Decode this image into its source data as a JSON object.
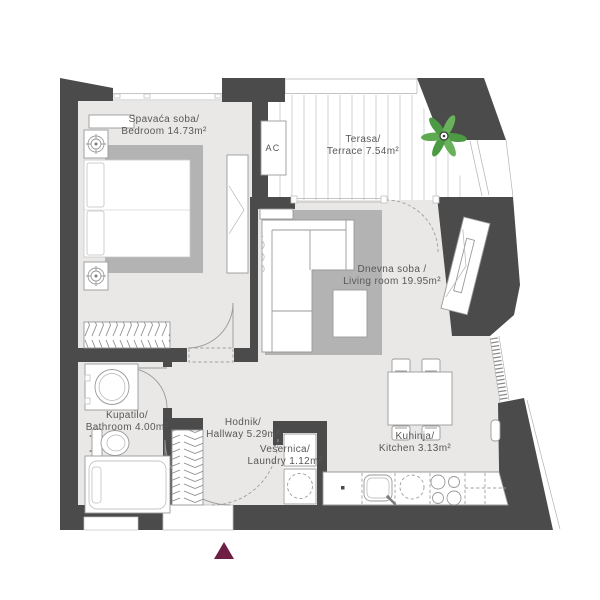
{
  "rooms": [
    {
      "id": "bedroom",
      "line1": "Spavaća soba/",
      "line2": "Bedroom 14.73m²",
      "area": "14.73m²"
    },
    {
      "id": "terrace",
      "line1": "Terasa/",
      "line2": "Terrace 7.54m²",
      "area": "7.54m²"
    },
    {
      "id": "living-room",
      "line1": "Dnevna soba /",
      "line2": "Living room 19.95m²",
      "area": "19.95m²"
    },
    {
      "id": "bathroom",
      "line1": "Kupatilo/",
      "line2": "Bathroom 4.00m²",
      "area": "4.00m²"
    },
    {
      "id": "hallway",
      "line1": "Hodnik/",
      "line2": "Hallway 5.29m²",
      "area": "5.29m²"
    },
    {
      "id": "laundry",
      "line1": "Vešernica/",
      "line2": "Laundry 1.12m²",
      "area": "1.12m²"
    },
    {
      "id": "kitchen",
      "line1": "Kuhinja/",
      "line2": "Kitchen 3.13m²",
      "area": "3.13m²"
    }
  ],
  "labels": {
    "ac_unit": "AC"
  },
  "colors": {
    "wall": "#4b4b4b",
    "floor": "#e9e8e6",
    "rug": "#b3b3b3",
    "furniture_outline": "#9a9a9a",
    "text": "#585858",
    "plant_green": "#55a04a",
    "entrance_marker": "#6e1e44",
    "deck_stripe": "#cccccc"
  }
}
